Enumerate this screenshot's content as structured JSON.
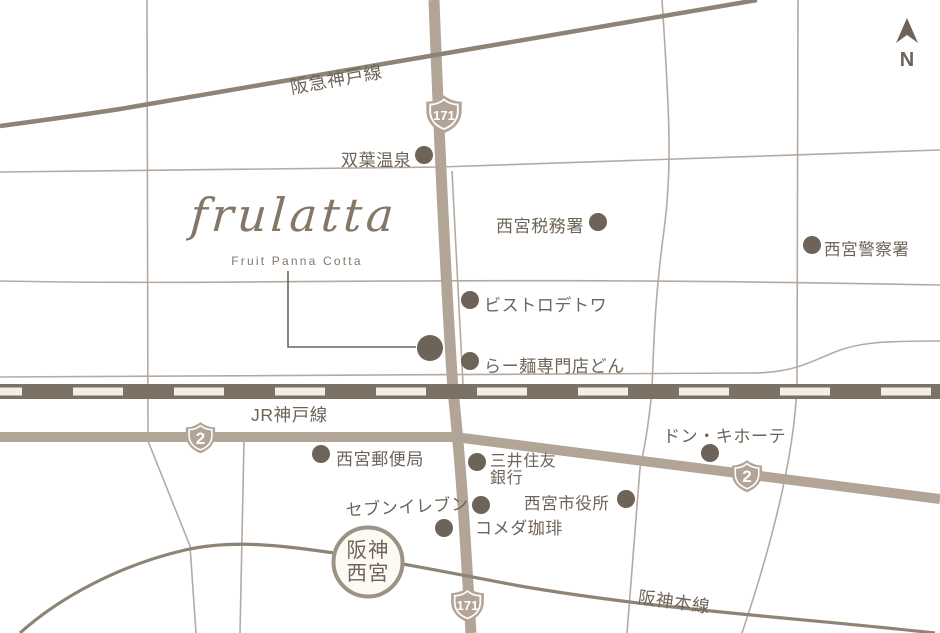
{
  "map": {
    "north_label": "N",
    "logo": {
      "name": "frulatta",
      "subtitle": "Fruit Panna Cotta"
    },
    "rail_lines": {
      "hankyu": "阪急神戸線",
      "jr": "JR神戸線",
      "hanshin": "阪神本線"
    },
    "station": {
      "line1": "阪神",
      "line2": "西宮"
    },
    "route_shields": {
      "r171": "171",
      "r2": "2"
    },
    "landmarks": {
      "futaba_onsen": "双葉温泉",
      "zeimusho": "西宮税務署",
      "keisatsusho": "西宮警察署",
      "bistro": "ビストロデトワ",
      "ramen_don": "らー麺専門店どん",
      "donki": "ドン・キホーテ",
      "yubinkyoku": "西宮郵便局",
      "mitsui_line1": "三井住友",
      "mitsui_line2": "銀行",
      "shiyakusho": "西宮市役所",
      "seven_eleven": "セブンイレブン",
      "komeda": "コメダ珈琲"
    },
    "colors": {
      "ink": "#6e6358",
      "road": "#b3a498",
      "railband": "#7b7164",
      "cream": "#f2efe3",
      "trainline": "#8d8376",
      "stationring": "#9c9285",
      "logo": "#847768",
      "thinroad": "#b6aaa0"
    }
  }
}
